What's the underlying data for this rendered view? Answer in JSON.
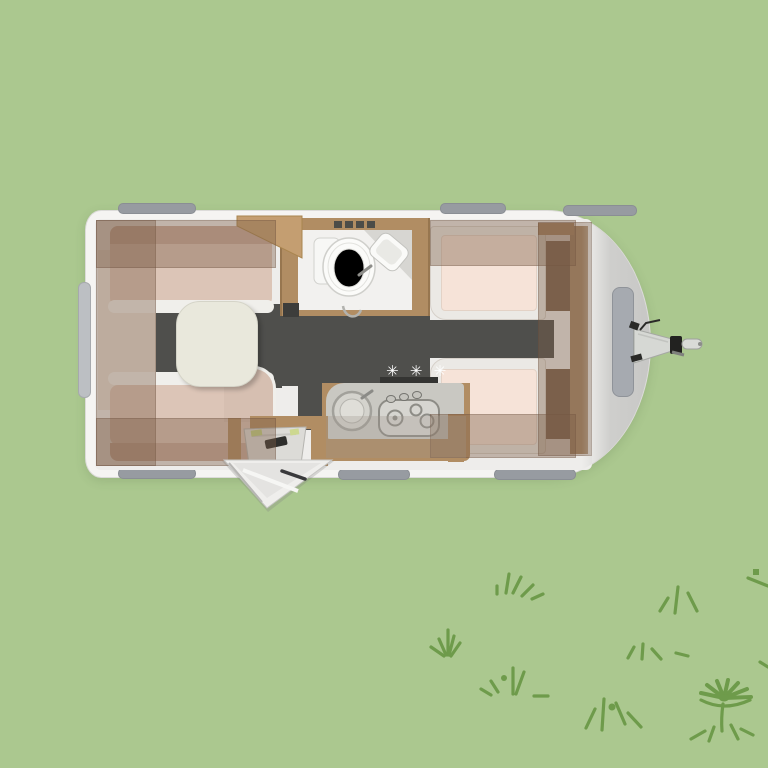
{
  "scene": {
    "background_color": "#abc88f",
    "doodles": {
      "color": "#6e9b4b",
      "items": [
        "grass-tuft",
        "grass-tuft",
        "grass-tuft",
        "grass-tuft",
        "grass-tuft",
        "grass-tuft",
        "dash",
        "dash",
        "dash",
        "daisy-flower"
      ]
    }
  },
  "floorplan": {
    "type": "caravan-top-view-floor-plan",
    "colors": {
      "body": "#f5f4f2",
      "front_shading": "#c7c7c5",
      "window_tab": "#979ba1",
      "gas_locker_lid": "#a6aab0",
      "floor": "#4f4f4c",
      "wood": "#b18d63",
      "overhead_locker_tint": "rgba(124,94,72,0.40)",
      "mattress": "#f6e3d8",
      "cushion": "#dcc5b7",
      "counter": "#c9c8c2",
      "table": "#e9e8dc"
    },
    "areas": {
      "dinette": {
        "name": "dinette-lounge"
      },
      "bathroom": {
        "name": "bathroom"
      },
      "kitchen": {
        "name": "kitchen",
        "hob_marker": "✳ ✳ ✳"
      },
      "beds": {
        "name": "twin-single-beds"
      },
      "entrance": {
        "name": "entrance-door-open"
      },
      "hitch": {
        "name": "tow-hitch"
      }
    }
  }
}
